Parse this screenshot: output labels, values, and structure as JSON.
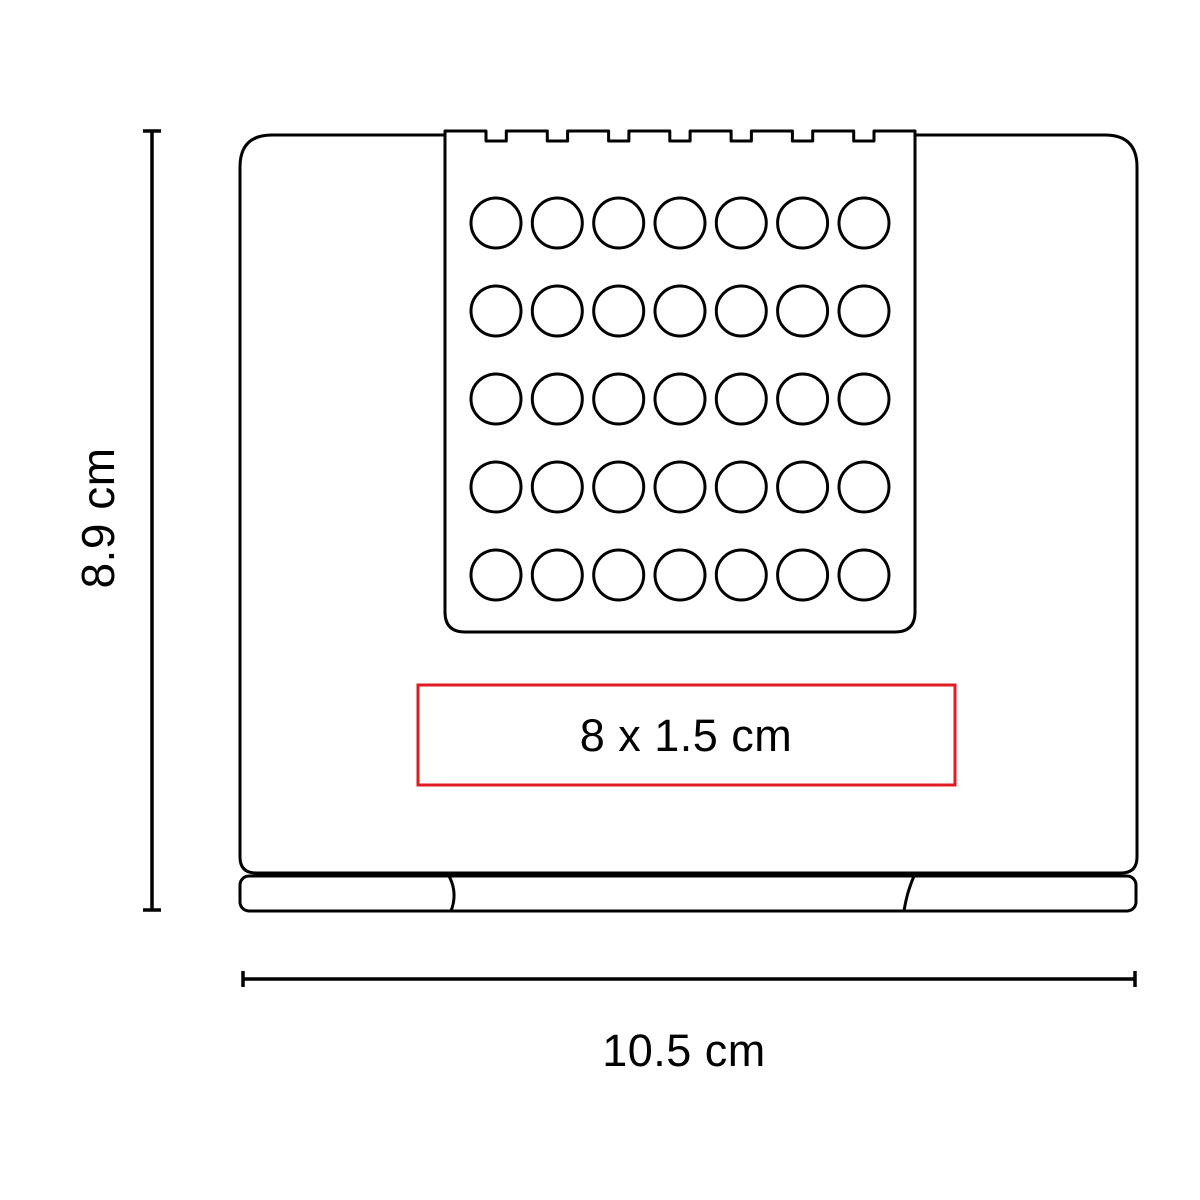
{
  "diagram": {
    "kind": "product-dimension-diagram",
    "dimensions": {
      "height_label": "8.9 cm",
      "width_label": "10.5 cm",
      "print_area_label": "8 x 1.5 cm"
    },
    "device": {
      "keypad": {
        "rows": 5,
        "columns": 7,
        "total_buttons": 35
      },
      "top_notches": 8,
      "base_segments": 3
    },
    "colors": {
      "line": "#000000",
      "text": "#000000",
      "print_area_border": "#e11b22",
      "background": "#ffffff"
    }
  }
}
